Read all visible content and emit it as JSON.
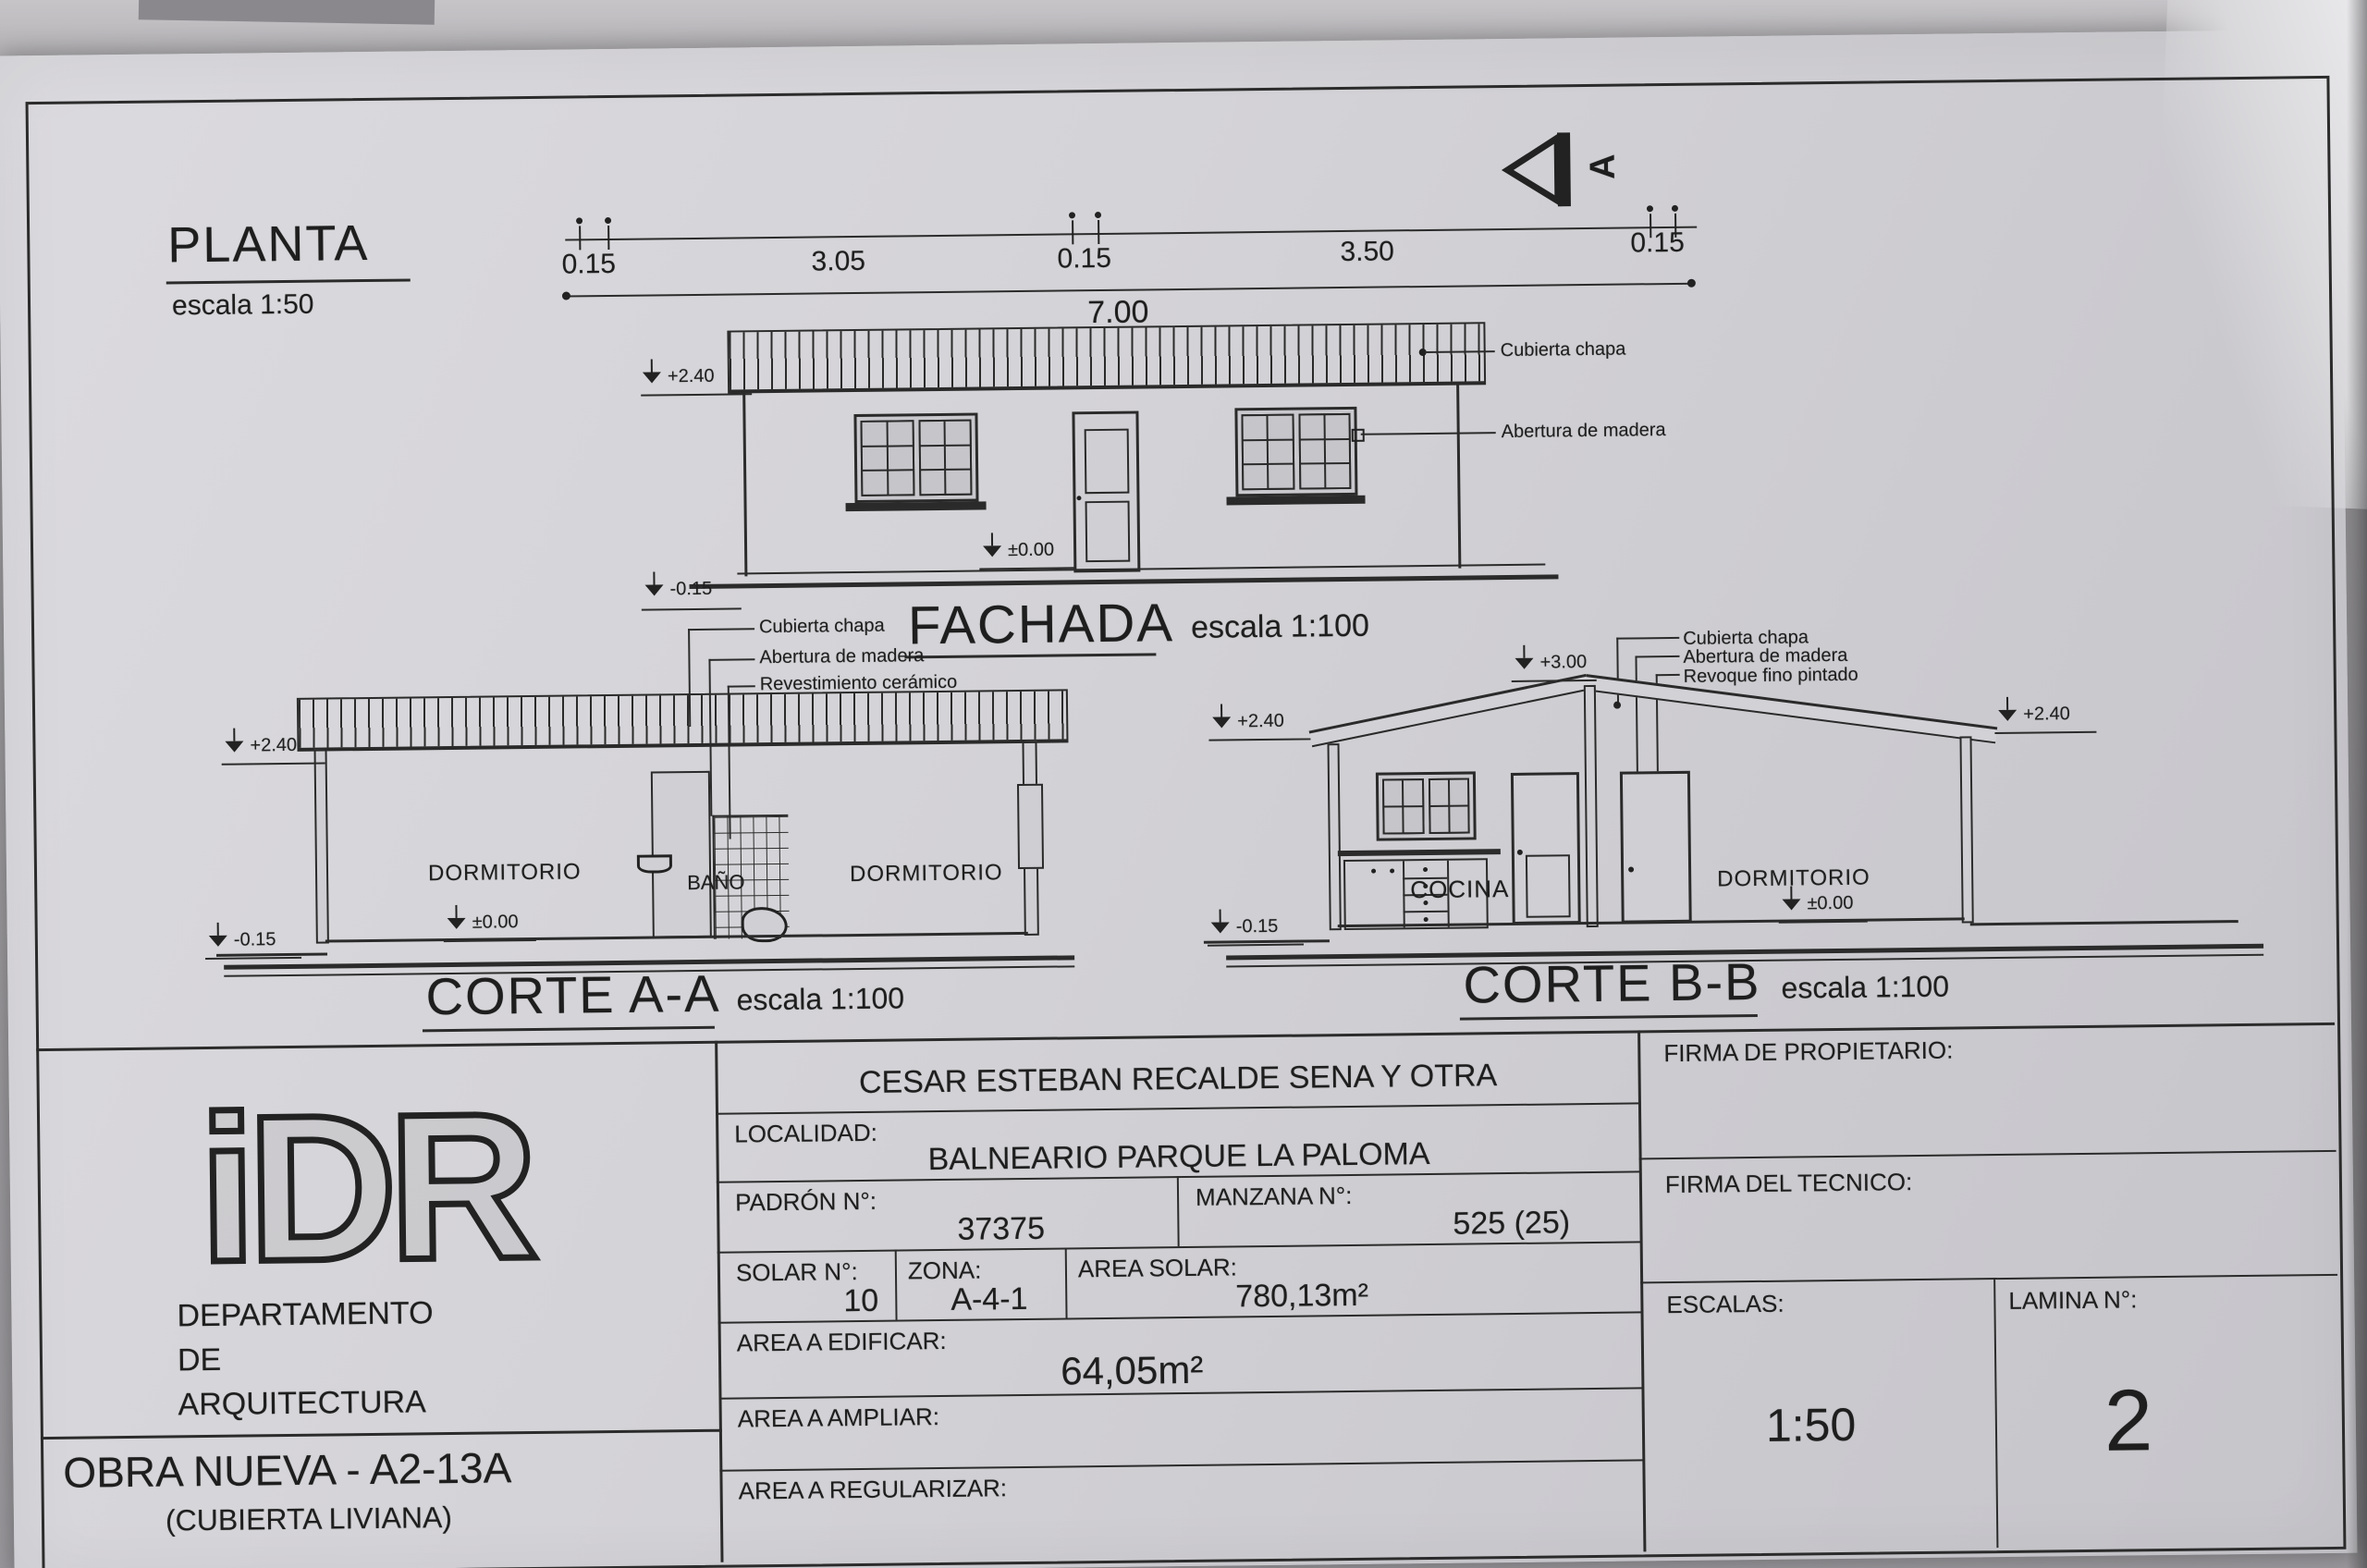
{
  "colors": {
    "paper": "#d4d3d7",
    "ink": "#2b2b2b",
    "photo_bg": "#a5a3a6"
  },
  "planta": {
    "title": "PLANTA",
    "scale": "escala 1:50",
    "dims": [
      "0.15",
      "3.05",
      "0.15",
      "3.50",
      "0.15"
    ],
    "total": "7.00",
    "section_marker": "A"
  },
  "fachada": {
    "title": "FACHADA",
    "scale": "escala 1:100",
    "label_roof": "Cubierta chapa",
    "label_opening": "Abertura de madera",
    "levels": {
      "top": "+2.40",
      "ground": "±0.00",
      "base": "-0.15"
    }
  },
  "corte_a": {
    "title": "CORTE A-A",
    "scale": "escala 1:100",
    "legend": [
      "Cubierta chapa",
      "Abertura de madera",
      "Revestimiento cerámico"
    ],
    "rooms": [
      "DORMITORIO",
      "BAÑO",
      "DORMITORIO"
    ],
    "levels": {
      "top": "+2.40",
      "ground": "±0.00",
      "base": "-0.15"
    }
  },
  "corte_b": {
    "title": "CORTE B-B",
    "scale": "escala 1:100",
    "legend": [
      "Cubierta chapa",
      "Abertura de madera",
      "Revoque fino pintado"
    ],
    "rooms": [
      "COCINA",
      "DORMITORIO"
    ],
    "levels": {
      "ridge": "+3.00",
      "eave_left": "+2.40",
      "eave_right": "+2.40",
      "ground": "±0.00",
      "base": "-0.15"
    }
  },
  "title_block": {
    "org": {
      "logo": "iDR",
      "dept_line1": "DEPARTAMENTO",
      "dept_line2": "DE",
      "dept_line3": "ARQUITECTURA",
      "work_type": "OBRA NUEVA - A2-13A",
      "work_subtype": "(CUBIERTA LIVIANA)"
    },
    "owner": "CESAR ESTEBAN RECALDE SENA Y OTRA",
    "localidad_label": "LOCALIDAD:",
    "localidad": "BALNEARIO PARQUE LA PALOMA",
    "padron_label": "PADRÓN N°:",
    "padron": "37375",
    "manzana_label": "MANZANA N°:",
    "manzana": "525 (25)",
    "solar_label": "SOLAR N°:",
    "solar": "10",
    "zona_label": "ZONA:",
    "zona": "A-4-1",
    "area_solar_label": "AREA SOLAR:",
    "area_solar": "780,13m²",
    "area_edificar_label": "AREA A EDIFICAR:",
    "area_edificar": "64,05m²",
    "area_ampliar_label": "AREA A AMPLIAR:",
    "area_regularizar_label": "AREA A REGULARIZAR:",
    "firma_propietario_label": "FIRMA DE PROPIETARIO:",
    "firma_tecnico_label": "FIRMA DEL TECNICO:",
    "escalas_label": "ESCALAS:",
    "escalas": "1:50",
    "lamina_label": "LAMINA N°:",
    "lamina": "2"
  }
}
